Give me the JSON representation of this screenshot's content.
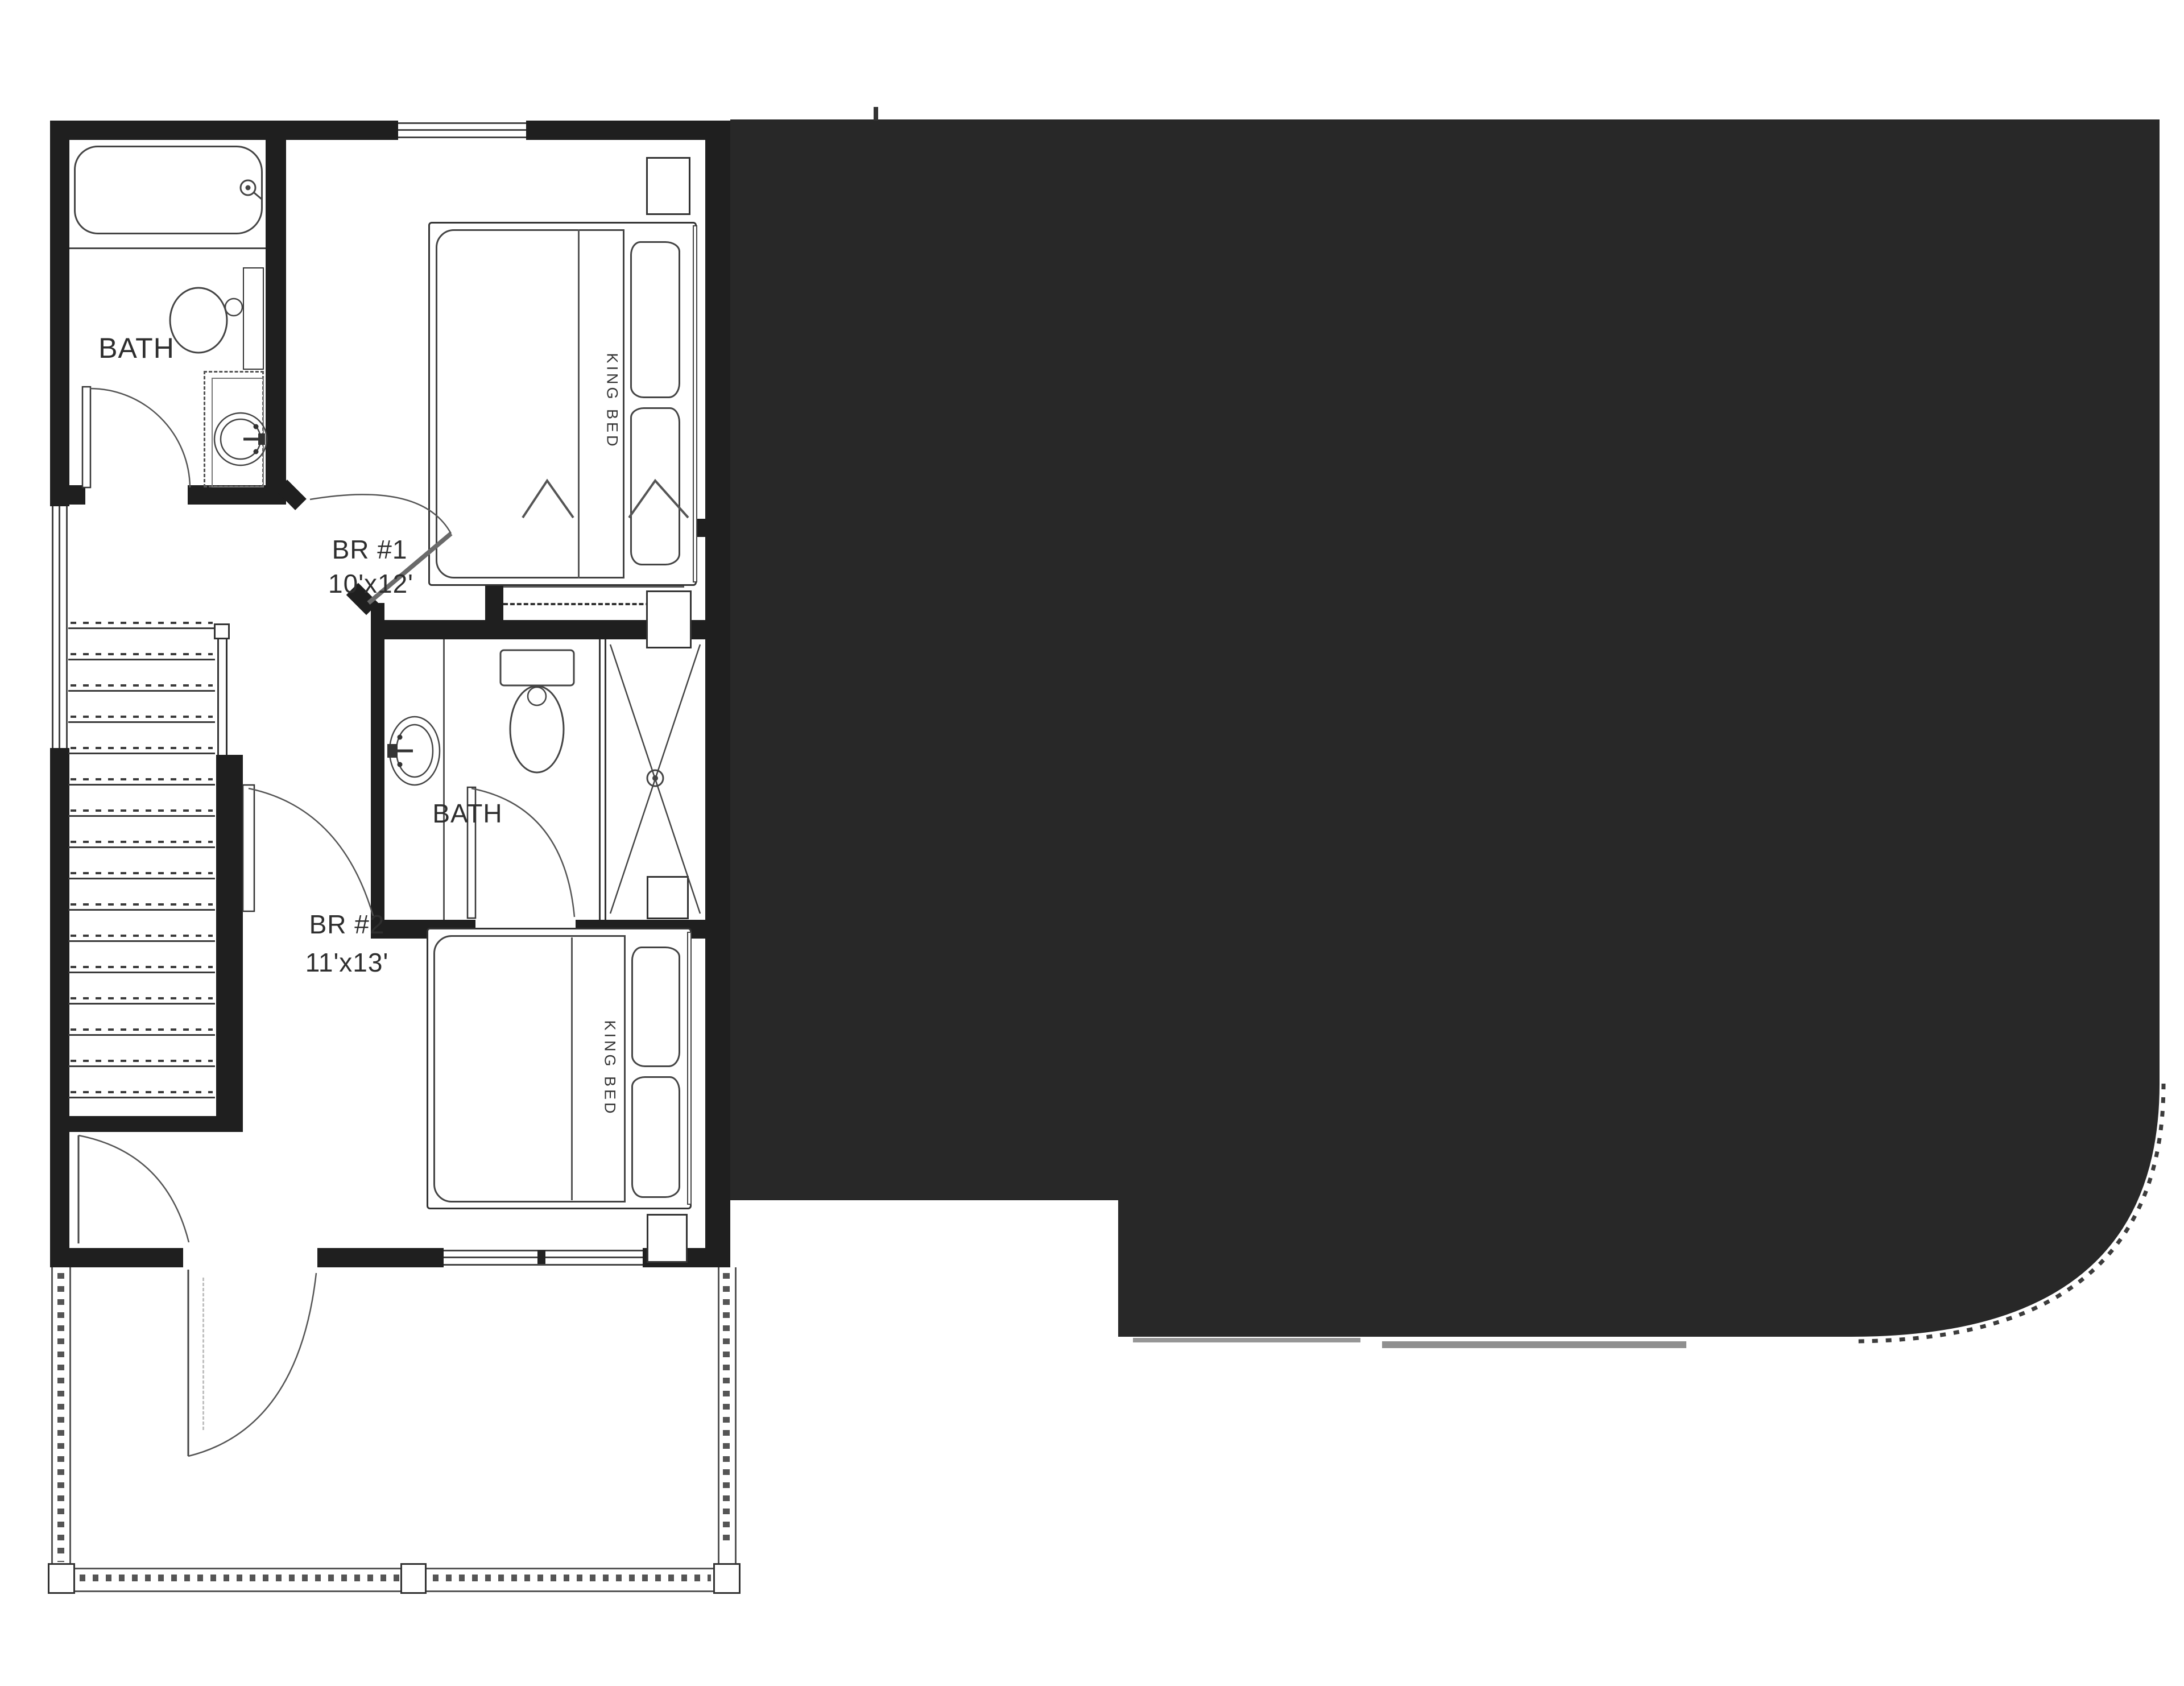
{
  "plan": {
    "title": "Upper floor unit plan",
    "labels": {
      "bath1": "BATH",
      "bath2": "BATH",
      "br1_name": "BR #1",
      "br1_size": "10'x12'",
      "br1_bed": "KING BED",
      "br2_name": "BR #2",
      "br2_size": "11'x13'",
      "br2_bed": "KING BED"
    },
    "rooms": [
      {
        "id": "bath-1",
        "label": "BATH"
      },
      {
        "id": "bedroom-1",
        "label": "BR #1",
        "size": "10'x12'",
        "furniture": "KING BED"
      },
      {
        "id": "bath-2",
        "label": "BATH"
      },
      {
        "id": "bedroom-2",
        "label": "BR #2",
        "size": "11'x13'",
        "furniture": "KING BED"
      }
    ],
    "colors": {
      "wall": "#1f1f1f",
      "redaction": "#282828",
      "line": "#444444",
      "text": "#2e2e2e",
      "background": "#ffffff"
    }
  }
}
